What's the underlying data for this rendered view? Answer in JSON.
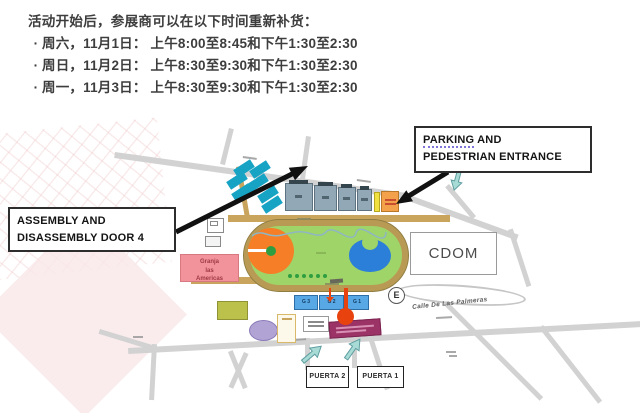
{
  "notice": {
    "title": "活动开始后，参展商可以在以下时间重新补货：",
    "bullet": "·",
    "items": [
      "周六，11月1日： 上午8:00至8:45和下午1:30至2:30",
      "周日，11月2日： 上午8:30至9:30和下午1:30至2:30",
      "周一，11月3日： 上午8:30至9:30和下午1:30至2:30"
    ]
  },
  "map": {
    "callouts": {
      "assembly": {
        "line1": "ASSEMBLY AND",
        "line2": "DISASSEMBLY DOOR 4"
      },
      "parking": {
        "word1": "PARKING",
        "rest1": " AND",
        "line2": "PEDESTRIAN ENTRANCE"
      }
    },
    "labels": {
      "cdom": "CDOM",
      "e_badge": "E",
      "street": "Calle De Las Palmeras",
      "granja_line1": "Granja",
      "granja_line2": "las",
      "granja_line3": "Americas",
      "puerta2": "PUERTA 2",
      "puerta1": "PUERTA 1",
      "hall_g3": "G 3",
      "hall_g2": "G 2",
      "hall_g1": "G 1"
    },
    "colors": {
      "teal_building": "#17a3c4",
      "gray_hall": "#93a8b6",
      "track_ring": "#b89a55",
      "infield_green": "#9fd468",
      "pond_blue": "#2b7fd8",
      "orange_circle": "#f57e27",
      "orange_building": "#f3a24b",
      "yellow_strip": "#f0e040",
      "pink_granja": "#f2929a",
      "blue_hall": "#58a8e6",
      "red_marker": "#e8430f",
      "magenta_building": "#9c3366",
      "olive_building": "#bcc14c",
      "purple_ellipse": "#b2a3d5",
      "cyan_arrow": "#a8dbd6",
      "road_gray": "#d2d2d2",
      "road_khaki": "#c9a45c",
      "watermark_pink": "#f9e7e9"
    }
  }
}
